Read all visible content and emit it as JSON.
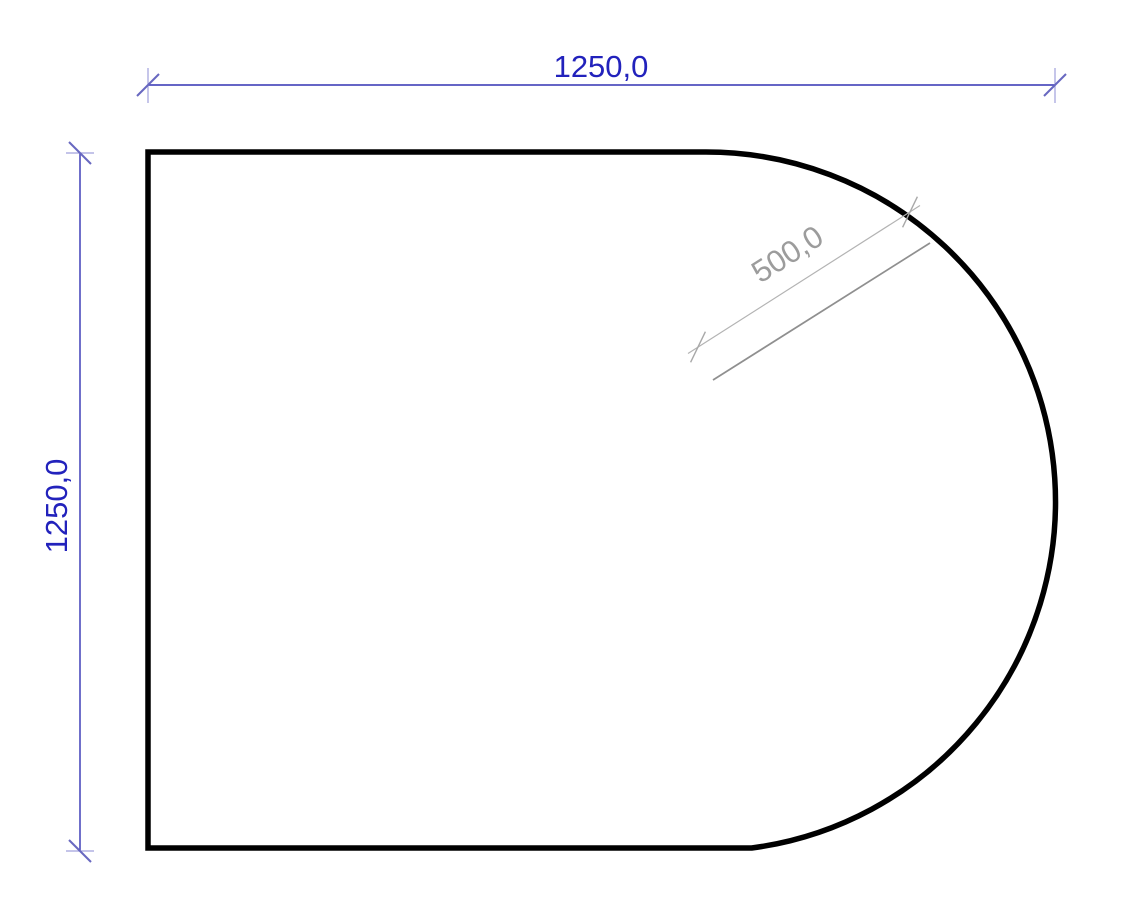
{
  "drawing": {
    "background": "#ffffff",
    "outline_color": "#000000",
    "dimensions": {
      "width": {
        "label": "1250,0",
        "text_color": "#2222bc",
        "line_color": "#3232b4",
        "tick_color": "#6868c0",
        "extension_color": "#a0a0dc"
      },
      "height": {
        "label": "1250,0",
        "text_color": "#2222bc",
        "line_color": "#3232b4",
        "tick_color": "#6868c0",
        "extension_color": "#a0a0dc"
      },
      "radius": {
        "label": "500,0",
        "text_color": "#9c9c9c",
        "line_color": "#b3b3b3",
        "tick_color": "#a8a8a8",
        "leader_color": "#8f8f8f"
      }
    }
  }
}
